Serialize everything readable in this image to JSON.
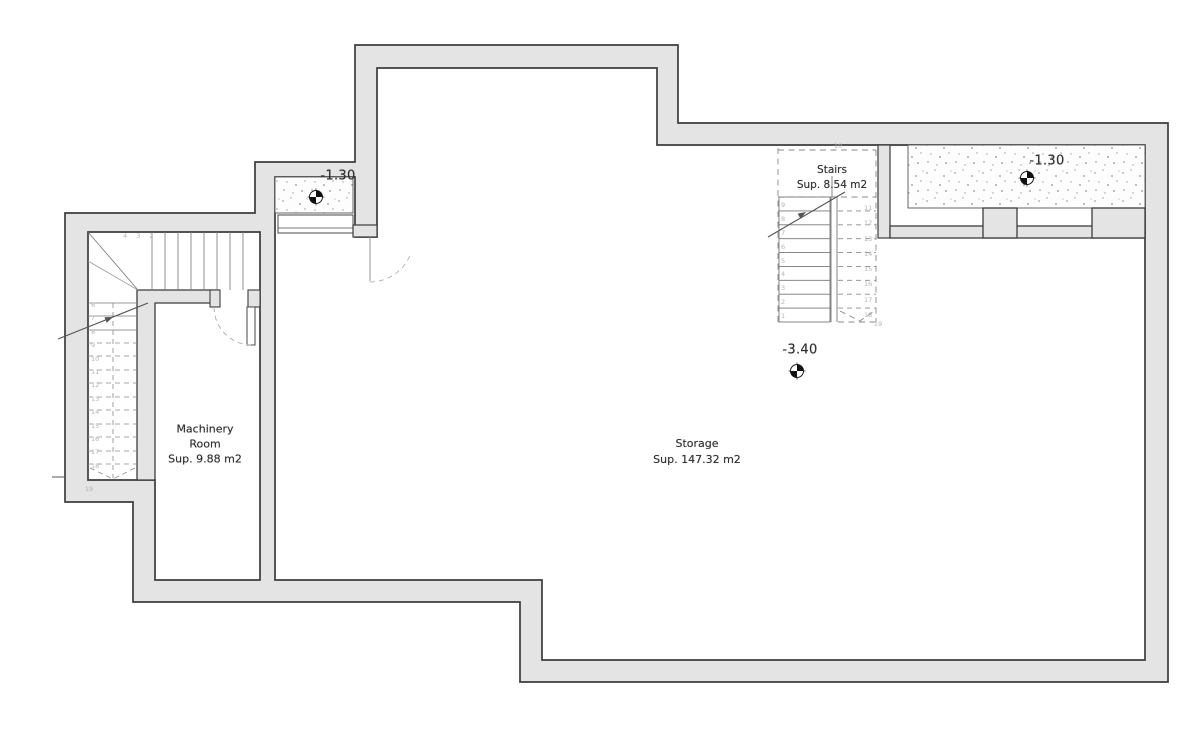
{
  "plan": {
    "rooms": {
      "machinery": {
        "line1": "Machinery",
        "line2": "Room",
        "area": "Sup. 9.88 m2"
      },
      "storage": {
        "name": "Storage",
        "area": "Sup. 147.32 m2"
      },
      "stairs": {
        "name": "Stairs",
        "area": "Sup. 8.54 m2"
      }
    },
    "levels": [
      {
        "id": "left-entrance",
        "value": "-1.30"
      },
      {
        "id": "right-entrance",
        "value": "-1.30"
      },
      {
        "id": "storage-floor",
        "value": "-3.40"
      }
    ],
    "stair_numbers": {
      "right_stair": {
        "top": "10",
        "bottom": "19",
        "up_run": [
          "9",
          "8",
          "7",
          "6",
          "5",
          "4",
          "3",
          "2",
          "1"
        ],
        "down_run": [
          "11",
          "12",
          "13",
          "14",
          "15",
          "16",
          "17",
          "18"
        ]
      },
      "left_stair": {
        "top_row": "4 3 2",
        "run": [
          "6",
          "7",
          "8",
          "9",
          "10",
          "11",
          "12",
          "13",
          "14",
          "15",
          "16",
          "17",
          "18"
        ],
        "bottom": "19"
      }
    },
    "colors": {
      "wall_fill": "#e4e4e4",
      "wall_line": "#3c3c3c",
      "thin_line": "#777777",
      "faint_line": "#9a9a9a",
      "text": "#2e2e2e",
      "tread_numbers": "#b3b3b3"
    }
  }
}
